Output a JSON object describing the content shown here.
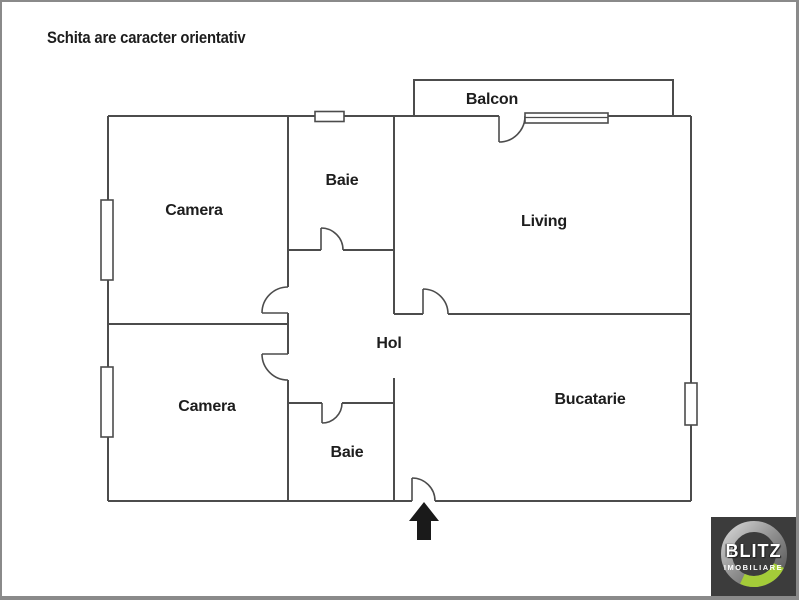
{
  "disclaimer": "Schita are caracter orientativ",
  "rooms": {
    "camera_top": "Camera",
    "baie_top": "Baie",
    "balcon": "Balcon",
    "living": "Living",
    "hol": "Hol",
    "camera_bottom": "Camera",
    "baie_bottom": "Baie",
    "bucatarie": "Bucatarie"
  },
  "icons": {
    "entrance": "entrance-arrow-icon"
  },
  "logo": {
    "brand": "BLITZ",
    "tagline": "IMOBILIARE"
  },
  "colors": {
    "wall": "#4c4c4c",
    "text": "#1d1d1d",
    "background": "#ffffff",
    "frame_border": "#8a8a8a",
    "arrow": "#1a1a1a",
    "logo_bg": "#3c3c3c",
    "logo_green": "#a4cc39",
    "logo_text": "#ffffff",
    "logo_ring_light": "#d2d2d2",
    "logo_ring_dark": "#555555"
  }
}
